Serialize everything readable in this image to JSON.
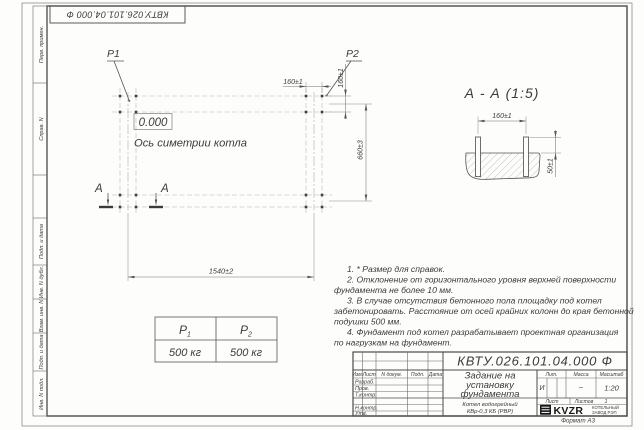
{
  "colors": {
    "ink": "#3b3b3b",
    "line": "#55554f",
    "paper": "#fdfdfc",
    "logo_black": "#161616"
  },
  "corner_stamp": {
    "doc_number": "КВТУ.026.101.04.000 Ф"
  },
  "side_strip": {
    "cells": [
      "Перв. примен.",
      "Справ. N",
      "Подп. и дата",
      "Инв. N дубл.",
      "Взам. инв. N",
      "Подп. и дата",
      "Инв. N подл."
    ]
  },
  "plan": {
    "p1": "P1",
    "p2": "P2",
    "elevation": "0.000",
    "axis_label": "Ось симетрии котла",
    "dim_bolt_x": "160±1",
    "dim_bolt_y": "160±1",
    "dim_width": "660±3",
    "dim_length": "1540±2",
    "section_letter_left": "А",
    "section_letter_right": "А"
  },
  "section": {
    "title": "А - А (1:5)",
    "dim_bolt": "160±1",
    "dim_height": "50±1"
  },
  "loads": {
    "cols": [
      {
        "base": "P",
        "sub": "1"
      },
      {
        "base": "P",
        "sub": "2"
      }
    ],
    "values": [
      "500 кг",
      "500 кг"
    ]
  },
  "notes": {
    "lines": [
      "1. * Размер для справок.",
      "2. Отклонение от горизонтального уровня верхней поверхности",
      "фундамента не более 10 мм.",
      "3. В случае отсутствия бетонного пола площадку под котел",
      "забетонировать. Расстояние от осей крайних колонн до края бетонной",
      "подушки 500 мм.",
      "4. Фундамент под котел разрабатывает проектная организация",
      "по нагрузкам на фундамент."
    ]
  },
  "title_block": {
    "doc_number": "КВТУ.026.101.04.000  Ф",
    "title_lines": [
      "Задание на",
      "установку",
      "фундамента"
    ],
    "product_lines": [
      "Котел водогрейный",
      "КВр-0,3 КБ  (РВР)"
    ],
    "cols": {
      "izm": "Изм.",
      "list": "Лист",
      "doc": "N докум.",
      "podp": "Подп.",
      "data": "Дата"
    },
    "rows": [
      "Разраб.",
      "Пров.",
      "Т.контр.",
      "Н.контр.",
      "Утв."
    ],
    "lit_label": "Лит.",
    "mass_label": "Масса",
    "scale_label": "Масштаб",
    "lit_value": "И",
    "mass_value": "–",
    "scale_value": "1:20",
    "sheet_label": "Лист",
    "sheets_label": "Листов",
    "sheets_value": "1",
    "logo_text": "KVZR",
    "logo_line1": "КОТЕЛЬНЫЙ",
    "logo_line2": "ЗАВОД РЭП"
  },
  "footer": {
    "format": "Формат А3"
  }
}
